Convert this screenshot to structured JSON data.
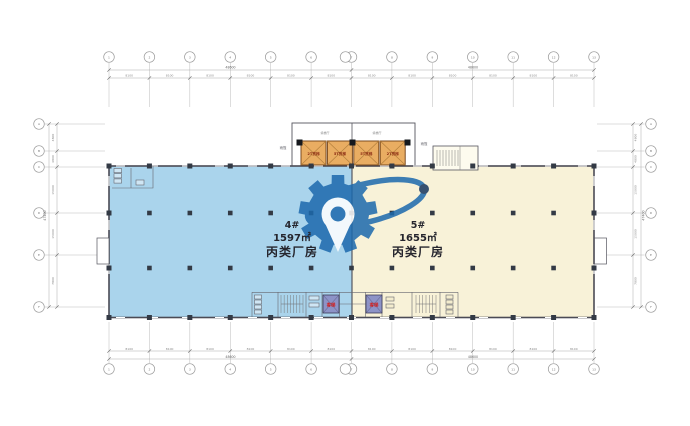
{
  "title": "factory-floor-plan",
  "buildings": [
    {
      "number": "4#",
      "area": "1597㎡",
      "category": "丙类厂房",
      "fill": "#aad4ec"
    },
    {
      "number": "5#",
      "area": "1655㎡",
      "category": "丙类厂房",
      "fill": "#f8f2d8"
    }
  ],
  "freight_elevators": [
    "2T货梯",
    "5T货梯",
    "5T货梯",
    "2T货梯"
  ],
  "annotations": {
    "lobby_left": "候梯厅",
    "lobby_right": "候梯厅",
    "canopy_left": "雨篷",
    "canopy_right": "雨篷",
    "passenger_left": "客梯",
    "passenger_right": "客梯"
  },
  "grid": {
    "top": {
      "labels": [
        "1",
        "2",
        "3",
        "4",
        "5",
        "6",
        "7",
        "8",
        "9",
        "10",
        "11",
        "12",
        "13"
      ],
      "segments": [
        "8100",
        "8100",
        "8100",
        "8100",
        "8100",
        "8100",
        "8100",
        "8100",
        "8100",
        "8100",
        "8100",
        "8100"
      ],
      "totals": [
        "48600",
        "48600"
      ]
    },
    "bottom": {
      "labels": [
        "1",
        "2",
        "3",
        "4",
        "5",
        "6",
        "7",
        "8",
        "9",
        "10",
        "11",
        "12",
        "13"
      ],
      "segments": [
        "8100",
        "8100",
        "8100",
        "8100",
        "8100",
        "8100",
        "8100",
        "8100",
        "8100",
        "8100",
        "8100",
        "8100"
      ],
      "totals": [
        "48600",
        "48600"
      ]
    },
    "left": {
      "labels": [
        "A",
        "B",
        "C",
        "D",
        "E",
        "F"
      ],
      "segments": [
        "4800",
        "4800",
        "15000",
        "15000",
        "7800"
      ],
      "total": "47400"
    },
    "right": {
      "labels": [
        "A",
        "B",
        "C",
        "D",
        "E",
        "F"
      ],
      "segments": [
        "4800",
        "4800",
        "15000",
        "15000",
        "7800"
      ],
      "total": "47400"
    }
  },
  "colors": {
    "building4_fill": "#aad4ec",
    "building5_fill": "#f8f2d8",
    "wall": "#4b4b55",
    "column": "#333a45",
    "freight_fill": "#e9ad62",
    "freight_border": "#7a4a1e",
    "freight_text": "#8a2b12",
    "passenger_fill": "#8d93c7",
    "passenger_text": "#d01f1f",
    "dim_line": "#aaaaaa",
    "dim_text": "#888888",
    "label_text": "#26262e",
    "watermark": "#1c69ad",
    "watermark_dot": "#16365f"
  }
}
